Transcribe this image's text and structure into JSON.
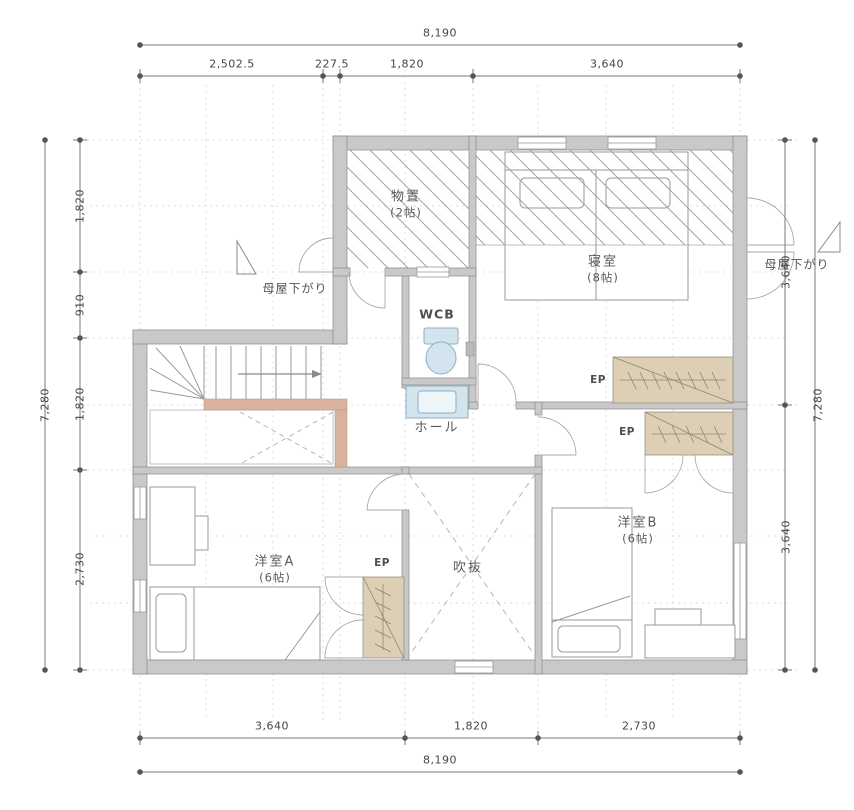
{
  "dimensions": {
    "top": {
      "overall": "8,190",
      "segments": [
        "2,502.5",
        "227.5",
        "1,820",
        "3,640"
      ]
    },
    "bottom": {
      "overall": "8,190",
      "segments": [
        "3,640",
        "1,820",
        "2,730"
      ]
    },
    "left": {
      "overall": "7,280",
      "segments": [
        "1,820",
        "910",
        "1,820",
        "2,730"
      ]
    },
    "right": {
      "overall": "7,280",
      "segments": [
        "3,640",
        "3,640"
      ]
    }
  },
  "rooms": {
    "storage": {
      "label": "物置",
      "size": "(2帖)"
    },
    "bedroom": {
      "label": "寝室",
      "size": "(8帖)"
    },
    "wc": {
      "label": "WCB"
    },
    "hall": {
      "label": "ホール"
    },
    "room_a": {
      "label": "洋室A",
      "size": "(6帖)"
    },
    "void": {
      "label": "吹抜"
    },
    "room_b": {
      "label": "洋室B",
      "size": "(6帖)"
    }
  },
  "annotations": {
    "moya_sagari_left": "母屋下がり",
    "moya_sagari_right": "母屋下がり",
    "ep_closet_bedroom": "EP",
    "ep_closet_room_b": "EP",
    "ep_closet_room_a": "EP"
  },
  "colors": {
    "wall_fill": "#c9c9c9",
    "wall_edge": "#8a8a8a",
    "closet_fill": "#dccfb4",
    "handrail": "#d9b29d",
    "fixture_fill": "#d3e4ee",
    "fixture_edge": "#8fafc2",
    "hatch_line": "#9f9f9f",
    "dim_text": "#454545",
    "label_text": "#5a5a5a"
  }
}
